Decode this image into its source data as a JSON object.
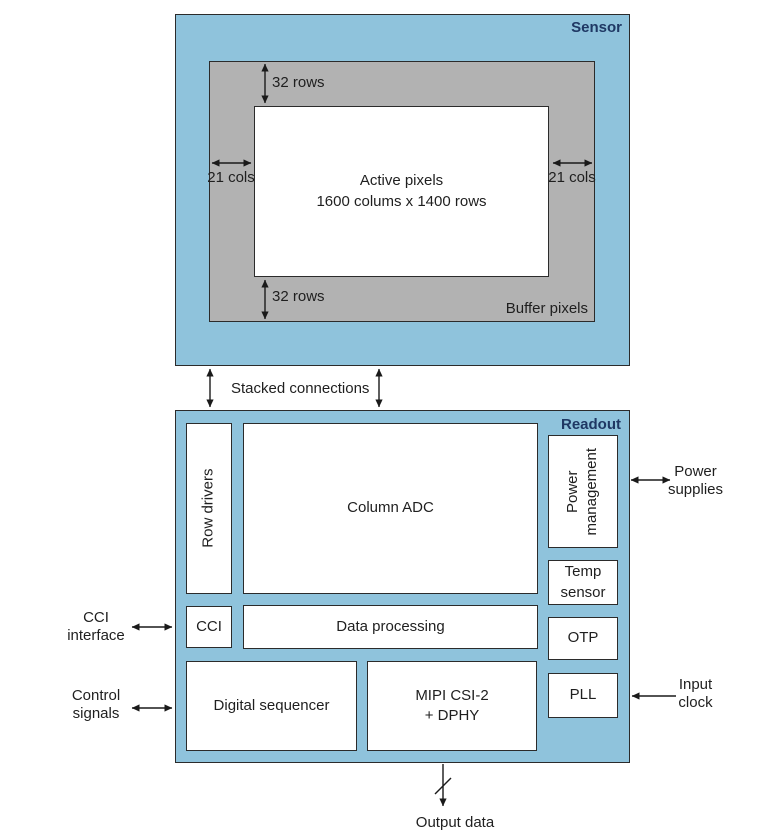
{
  "sensor": {
    "title": "Sensor",
    "buffer_label": "Buffer pixels",
    "active_pixels": "Active pixels\n1600 colums x 1400 rows",
    "dim_top_rows": "32 rows",
    "dim_bottom_rows": "32 rows",
    "dim_left_cols": "21 cols",
    "dim_right_cols": "21 cols"
  },
  "interconnect": {
    "label": "Stacked connections"
  },
  "readout": {
    "title": "Readout",
    "row_drivers": "Row drivers",
    "column_adc": "Column ADC",
    "power_management": "Power\nmanagement",
    "temp_sensor": "Temp\nsensor",
    "cci": "CCI",
    "data_processing": "Data processing",
    "otp": "OTP",
    "digital_sequencer": "Digital sequencer",
    "mipi": "MIPI CSI-2\n+ DPHY",
    "pll": "PLL"
  },
  "external": {
    "cci_interface": "CCI\ninterface",
    "control_signals": "Control\nsignals",
    "power_supplies": "Power\nsupplies",
    "input_clock": "Input\nclock",
    "output_data": "Output data"
  },
  "colors": {
    "chip_fill": "#8FC3DC",
    "buffer_fill": "#B2B2B2",
    "block_fill": "#FFFFFF",
    "border": "#2B2B2B",
    "title_text": "#1F3864",
    "body_text": "#1F1F1F",
    "arrow": "#1A1A1A"
  }
}
